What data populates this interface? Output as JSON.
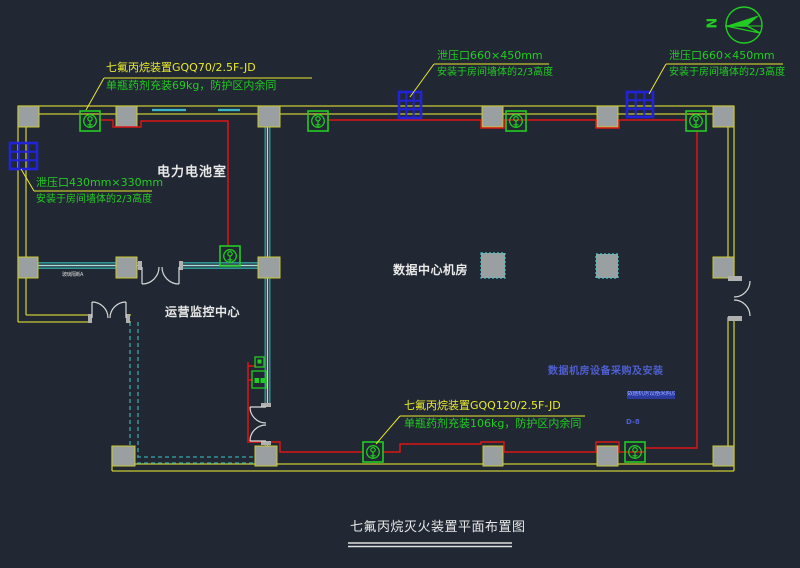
{
  "title": "七氟丙烷灭火装置平面布置图",
  "compass": {
    "north_label": "N"
  },
  "rooms": {
    "battery": "电力电池室",
    "data_center": "数据中心机房",
    "monitor": "运营监控中心"
  },
  "annotations": {
    "gqq70": {
      "line1": "七氟丙烷装置GQQ70/2.5F-JD",
      "line2": "单瓶药剂充装69kg，防护区内余同"
    },
    "gqq120": {
      "line1": "七氟丙烷装置GQQ120/2.5F-JD",
      "line2": "单瓶药剂充装106kg，防护区内余同"
    },
    "vent_left": {
      "line1": "泄压口430mm×330mm",
      "line2": "安装于房间墙体的2/3高度"
    },
    "vent_top_mid": {
      "line1": "泄压口660×450mm",
      "line2": "安装于房间墙体的2/3高度"
    },
    "vent_top_right": {
      "line1": "泄压口660×450mm",
      "line2": "安装于房间墙体的2/3高度"
    },
    "project_note": "数据机房设备采购及安装",
    "highlighted_note": "数据机房设备采购及安装",
    "ref_code": "D-8",
    "partition_note": "玻璃隔断A"
  },
  "colors": {
    "background": "#212833",
    "wall_yellow": "#c9c930",
    "annotation_yellow": "#e9e92b",
    "annotation_green": "#22cc22",
    "pipe_red": "#da1616",
    "vent_blue": "#2222d6",
    "partition_teal": "#2f9494",
    "note_blue": "#4e5ecf",
    "text_white": "#e8e8e8",
    "column_gray": "#9aa0a2"
  }
}
